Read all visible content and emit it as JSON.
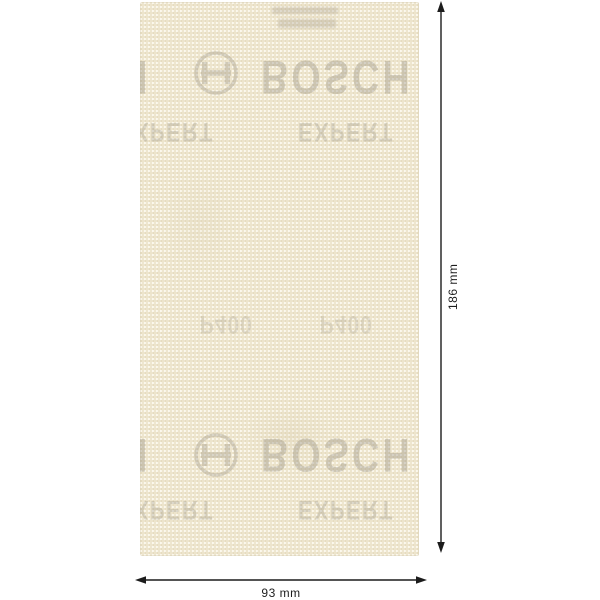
{
  "product_sheet": {
    "brand": "BOSCH",
    "series": "EXPERT",
    "grit": "P400"
  },
  "annotations": {
    "height": "186 mm",
    "width": "93 mm"
  },
  "colors": {
    "background": "#ffffff",
    "sheet_base": "#f3edd9",
    "weave_light": "#fbf8ee",
    "weave_dark": "#e0d5b4",
    "watermark_text": "#8e887a",
    "dimension_lines": "#1c1c1c"
  }
}
